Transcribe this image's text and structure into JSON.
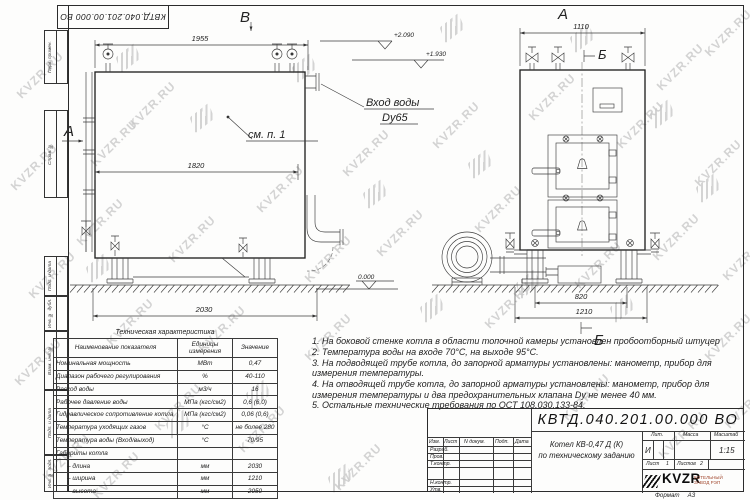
{
  "page": {
    "format_label": "Формат",
    "format_value": "А3"
  },
  "stamp": {
    "code": "КВТД.040.201.00.000  ВО"
  },
  "frame": {
    "side_labels": [
      "Перв. примен.",
      "Справ. №",
      "Подп. и дата",
      "Инв. № дубл.",
      "Взам. инв. №",
      "Подп. и дата",
      "Инв. № подл."
    ]
  },
  "views": {
    "left": {
      "label_a": "А",
      "label_b": "В",
      "callout": "см. п. 1",
      "dim_top": "1955",
      "dim_mid": "1820",
      "dim_bottom": "2030",
      "level_zero": "0.000",
      "level_upper": "+2.090",
      "level_lower": "+1.930",
      "inlet_line1": "Вход воды",
      "inlet_line2": "Dy65"
    },
    "right": {
      "label_a": "А",
      "label_b_top": "Б",
      "label_b_bottom": "Б",
      "dim_top": "1110",
      "dim_inner": "820",
      "dim_outer": "1210"
    }
  },
  "spec_table": {
    "title": "Техническая характеристика",
    "headers": [
      "Наименование показателя",
      "Единицы измерения",
      "Значение"
    ],
    "rows": [
      [
        "Номинальная мощность",
        "МВт",
        "0,47"
      ],
      [
        "Диапазон рабочего регулирования",
        "%",
        "40-110"
      ],
      [
        "Расход воды",
        "м3/ч",
        "16"
      ],
      [
        "Рабочее давление воды",
        "МПа (кгс/см2)",
        "0,6 (6,0)"
      ],
      [
        "Гидравлическое сопротивление котла",
        "МПа (кгс/см2)",
        "0,06 (0,6)"
      ],
      [
        "Температура уходящих газов",
        "°С",
        "не более 280"
      ],
      [
        "Температура воды (Вход/выход)",
        "°С",
        "70/95"
      ],
      [
        "Габариты котла",
        "",
        ""
      ],
      [
        "– длина",
        "мм",
        "2030"
      ],
      [
        "– ширина",
        "мм",
        "1210"
      ],
      [
        "– высота",
        "мм",
        "2050"
      ]
    ]
  },
  "notes": [
    "1.  На боковой стенке котла в области топочной камеры установлен пробоотборный штуцер",
    "2.  Температура воды на входе 70°С, на выходе 95°С.",
    "3.  На подводящей трубе котла, до запорной арматуры установлены: манометр, прибор для измерения температуры.",
    "4.  На отводящей трубе котла, до запорной арматуры установлены: манометр, прибор для измерения температуры и два предохранительных клапана Dу не менее 40 мм.",
    "5.  Остальные технические требования по ОСТ 108.030.133-84."
  ],
  "title_block": {
    "code": "КВТД.040.201.00.000  ВО",
    "name_line1": "Котел КВ-0,47 Д (К)",
    "name_line2": "по техническому заданию",
    "col_headers": {
      "izm": "Изм.",
      "list": "Лист",
      "ndoc": "N докум.",
      "podp": "Подп.",
      "data": "Дата"
    },
    "sign_rows": {
      "razrab": "Разраб.",
      "prov": "Пров.",
      "tkontr": "Т.контр.",
      "nkontr": "Н.контр.",
      "utv": "Утв."
    },
    "lit_label": "Лит.",
    "mass_label": "Масса",
    "scale_label": "Масштаб",
    "lit_value": "И",
    "scale_value": "1:15",
    "sheet_label": "Лист",
    "sheet_value": "1",
    "sheets_label": "Листов",
    "sheets_value": "2",
    "logo_text": "KVZR",
    "company_line1": "КОТЕЛЬНЫЙ",
    "company_line2": "ЗАВОД РЭП"
  },
  "watermark": {
    "text": "KVZR.RU"
  }
}
